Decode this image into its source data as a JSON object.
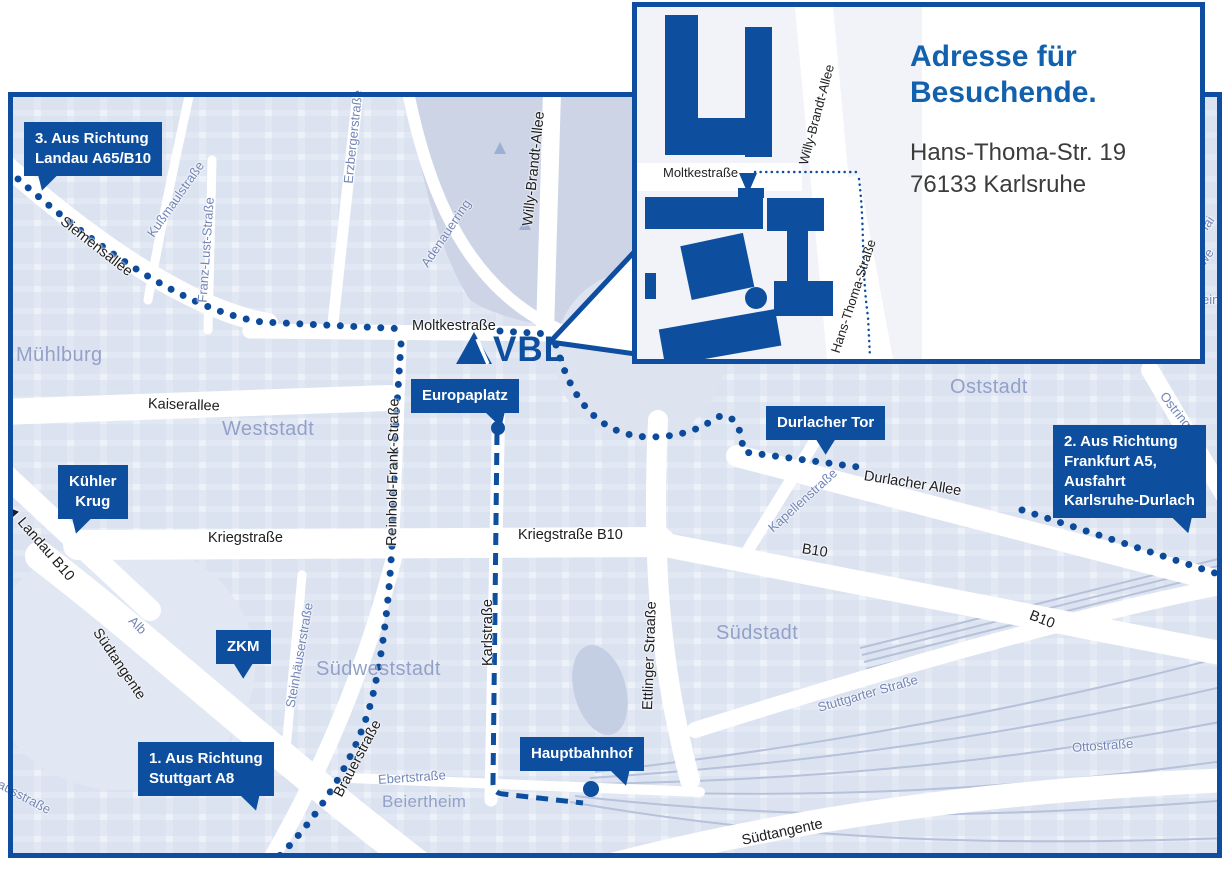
{
  "colors": {
    "brand_blue": "#0d4f9e",
    "title_blue": "#1261ae",
    "route_blue": "#0c4b9c",
    "map_background": "#edf1f8",
    "city_block": "#cdd5e7",
    "park": "#ccd4e6",
    "area_label": "#93a1c9",
    "minor_street_label": "#7185b6",
    "street_label": "#1d1d1f"
  },
  "logo": {
    "text": "VBL"
  },
  "inset": {
    "title_line1": "Adresse für",
    "title_line2": "Besuchende.",
    "address_line1": "Hans-Thoma-Str. 19",
    "address_line2": "76133 Karlsruhe",
    "street_labels": [
      {
        "t": "Moltkestraße",
        "x": 26,
        "y": 158,
        "r": 0
      },
      {
        "t": "Willy-Brandt-Allee",
        "x": 166,
        "y": 150,
        "r": -75
      },
      {
        "t": "Hans-Thoma-Straße",
        "x": 198,
        "y": 338,
        "r": -72
      }
    ]
  },
  "map": {
    "callouts": [
      {
        "id": "landau",
        "lines": [
          "3. Aus Richtung",
          "Landau A65/B10"
        ],
        "x": 24,
        "y": 122,
        "tail": "bl"
      },
      {
        "id": "frankfurt",
        "lines": [
          "2. Aus Richtung",
          "Frankfurt A5,",
          "Ausfahrt",
          "Karlsruhe-Durlach"
        ],
        "x": 1053,
        "y": 425,
        "tail": "br"
      },
      {
        "id": "stuttgart",
        "lines": [
          "1. Aus Richtung",
          "Stuttgart A8"
        ],
        "x": 138,
        "y": 742,
        "tail": "br"
      },
      {
        "id": "kuehler-krug",
        "lines": [
          "Kühler",
          "Krug"
        ],
        "x": 58,
        "y": 465,
        "tail": "bl",
        "align": "center"
      },
      {
        "id": "zkm",
        "lines": [
          "ZKM"
        ],
        "x": 216,
        "y": 630,
        "tail": "b",
        "align": "center"
      },
      {
        "id": "europaplatz",
        "lines": [
          "Europaplatz"
        ],
        "x": 411,
        "y": 379,
        "tail": "br",
        "dot": {
          "x": 498,
          "y": 428,
          "r": 7
        }
      },
      {
        "id": "durlacher-tor",
        "lines": [
          "Durlacher Tor"
        ],
        "x": 766,
        "y": 406,
        "tail": "b"
      },
      {
        "id": "hauptbahnhof",
        "lines": [
          "Hauptbahnhof"
        ],
        "x": 520,
        "y": 737,
        "tail": "br",
        "dot": {
          "x": 591,
          "y": 789,
          "r": 8
        }
      }
    ],
    "labels": [
      {
        "t": "Siemensallee",
        "x": 62,
        "y": 212,
        "r": 38,
        "c": "st"
      },
      {
        "t": "Moltkestraße",
        "x": 412,
        "y": 318,
        "r": 0,
        "c": "st"
      },
      {
        "t": "Kaiserallee",
        "x": 148,
        "y": 396,
        "r": 2,
        "c": "st"
      },
      {
        "t": "Kriegstraße",
        "x": 208,
        "y": 530,
        "r": 0,
        "c": "st"
      },
      {
        "t": "Kriegstraße B10",
        "x": 518,
        "y": 527,
        "r": 0,
        "c": "st"
      },
      {
        "t": "Durlacher Allee",
        "x": 864,
        "y": 468,
        "r": 9,
        "c": "st"
      },
      {
        "t": "B10",
        "x": 802,
        "y": 541,
        "r": 9,
        "c": "st"
      },
      {
        "t": "B10",
        "x": 1030,
        "y": 607,
        "r": 22,
        "c": "st"
      },
      {
        "t": "◄ Landau B10",
        "x": 8,
        "y": 498,
        "r": 49,
        "c": "st"
      },
      {
        "t": "Südtangente",
        "x": 96,
        "y": 622,
        "r": 56,
        "c": "st"
      },
      {
        "t": "Südtangente",
        "x": 742,
        "y": 833,
        "r": -12,
        "c": "st"
      },
      {
        "t": "Brauerstraße",
        "x": 338,
        "y": 788,
        "r": -62,
        "c": "st"
      },
      {
        "t": "Karlstraße",
        "x": 488,
        "y": 658,
        "r": -90,
        "c": "st"
      },
      {
        "t": "Ettlinger Straaße",
        "x": 648,
        "y": 702,
        "r": -88,
        "c": "st"
      },
      {
        "t": "Reinhold-Frank-Straße",
        "x": 392,
        "y": 538,
        "r": -89,
        "c": "st"
      },
      {
        "t": "Willy-Brandt-Allee",
        "x": 528,
        "y": 218,
        "r": -84,
        "c": "st"
      },
      {
        "t": "Erzbergerstraße",
        "x": 348,
        "y": 176,
        "r": -84,
        "c": "min"
      },
      {
        "t": "Adenauerring",
        "x": 424,
        "y": 258,
        "r": -56,
        "c": "min"
      },
      {
        "t": "Kußmaulstraße",
        "x": 150,
        "y": 228,
        "r": -55,
        "c": "min"
      },
      {
        "t": "Franz-Lust-Straße",
        "x": 202,
        "y": 295,
        "r": -86,
        "c": "min"
      },
      {
        "t": "Steinhäuserstraße",
        "x": 290,
        "y": 700,
        "r": -80,
        "c": "min"
      },
      {
        "t": "Kapellenstraße",
        "x": 770,
        "y": 522,
        "r": -42,
        "c": "min"
      },
      {
        "t": "Stuttgarter Straße",
        "x": 818,
        "y": 700,
        "r": -16,
        "c": "min"
      },
      {
        "t": "Ottostraße",
        "x": 1072,
        "y": 740,
        "r": -4,
        "c": "min"
      },
      {
        "t": "Ostring",
        "x": 1163,
        "y": 386,
        "r": 52,
        "c": "min"
      },
      {
        "t": "Alb",
        "x": 131,
        "y": 611,
        "r": 45,
        "c": "min"
      },
      {
        "t": "Ebertstraße",
        "x": 378,
        "y": 772,
        "r": -4,
        "c": "min"
      },
      {
        "t": "Pulverhausstraße",
        "x": -40,
        "y": 755,
        "r": 28,
        "c": "min"
      },
      {
        "t": "Hai",
        "x": 1200,
        "y": 226,
        "r": -55,
        "c": "min"
      },
      {
        "t": "we",
        "x": 1201,
        "y": 256,
        "r": -55,
        "c": "min"
      },
      {
        "t": "ein",
        "x": 1202,
        "y": 292,
        "r": 0,
        "c": "min"
      },
      {
        "t": "Mühlburg",
        "x": 16,
        "y": 344,
        "r": 0,
        "c": "area"
      },
      {
        "t": "Weststadt",
        "x": 222,
        "y": 418,
        "r": 0,
        "c": "area"
      },
      {
        "t": "Oststadt",
        "x": 950,
        "y": 376,
        "r": 0,
        "c": "area"
      },
      {
        "t": "Südstadt",
        "x": 716,
        "y": 622,
        "r": 0,
        "c": "area"
      },
      {
        "t": "Südweststadt",
        "x": 316,
        "y": 658,
        "r": 0,
        "c": "area"
      },
      {
        "t": "Beiertheim",
        "x": 382,
        "y": 792,
        "r": 0,
        "c": "areaSm"
      }
    ]
  }
}
